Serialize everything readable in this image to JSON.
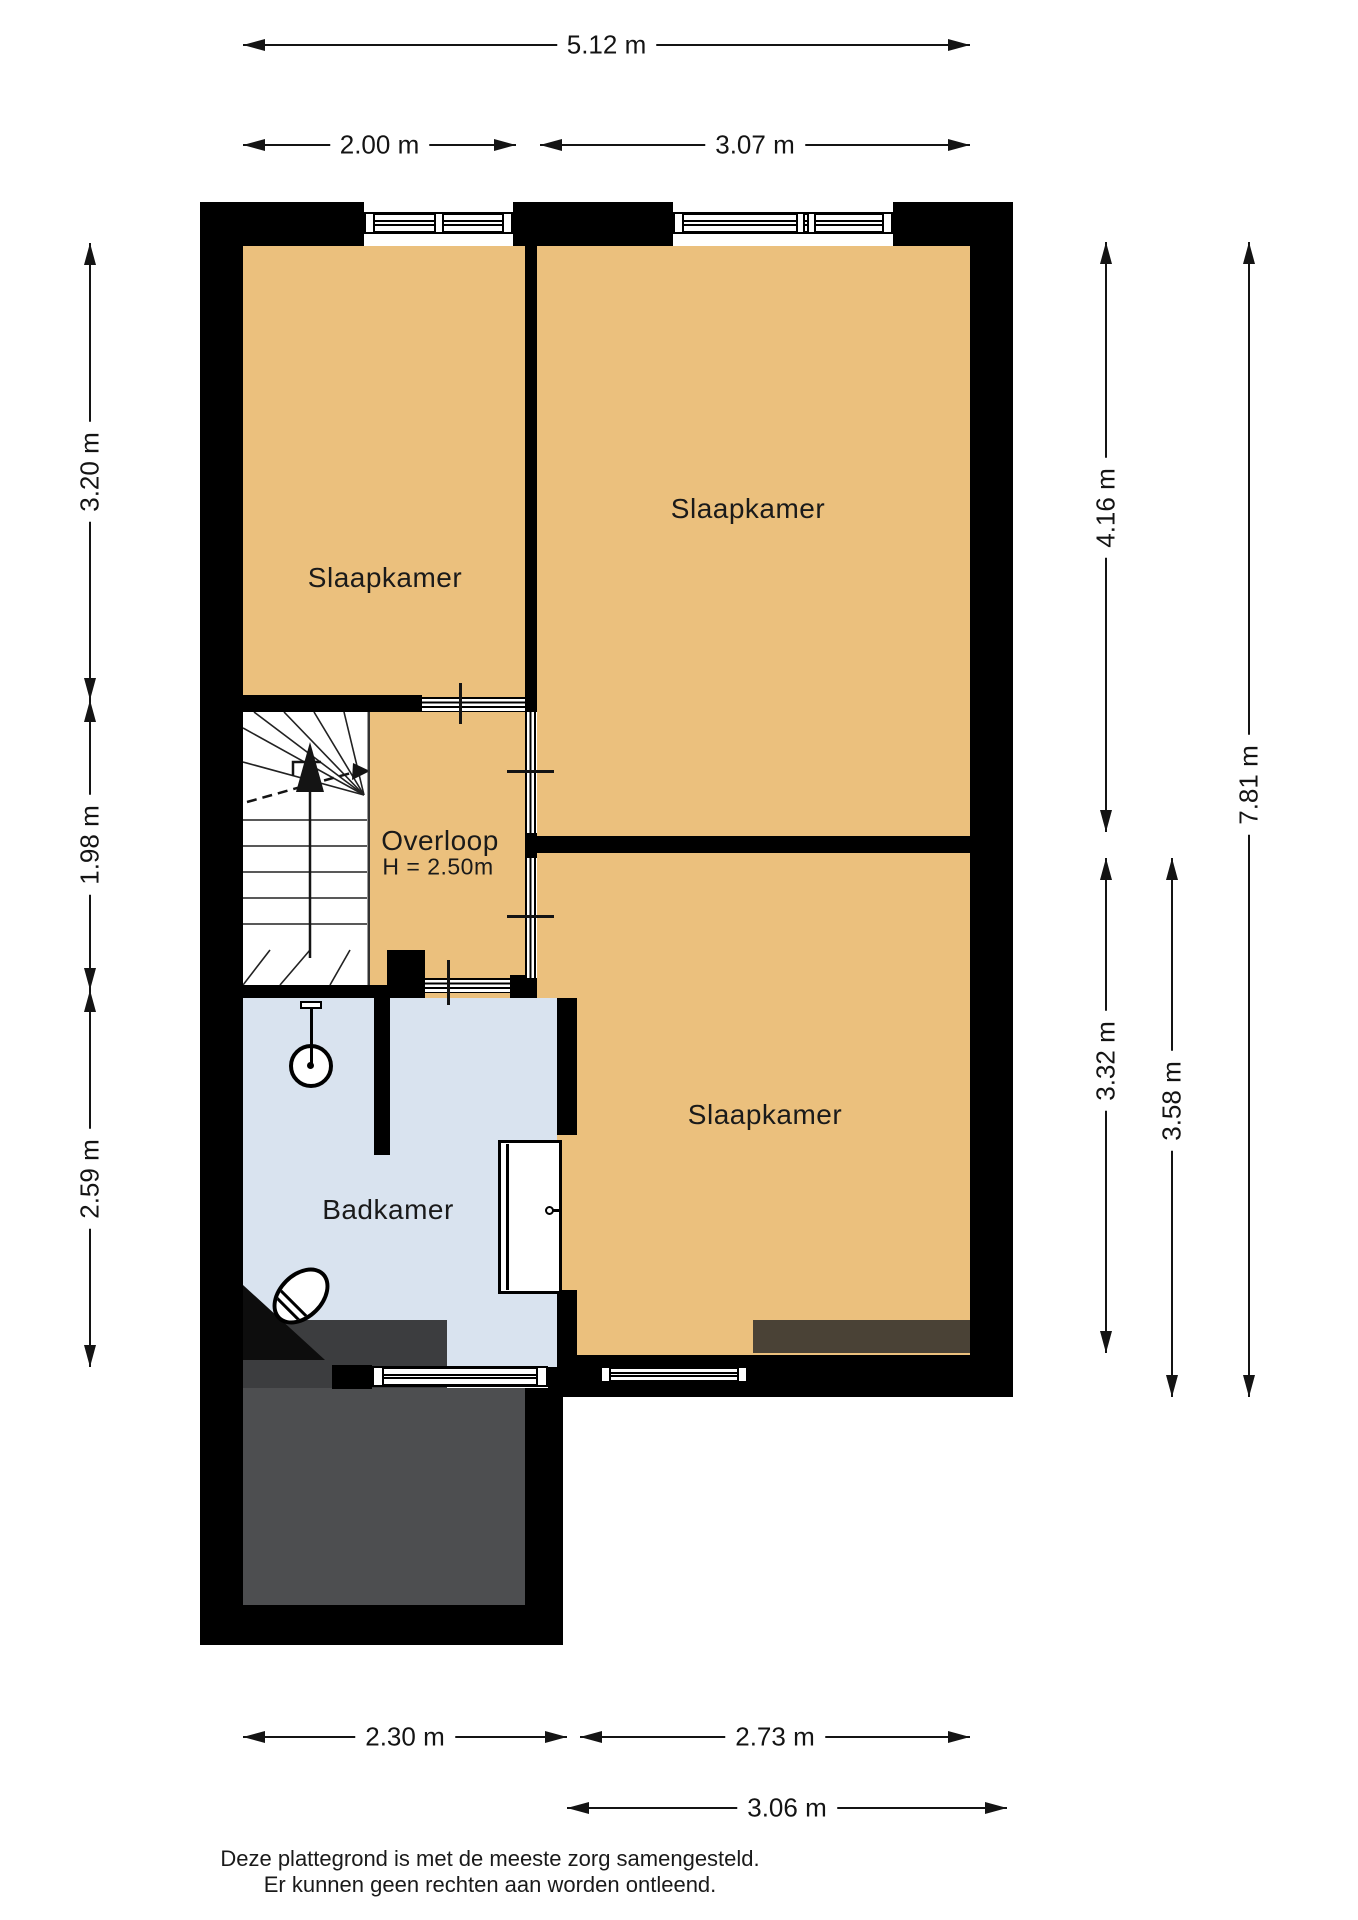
{
  "plan": {
    "rooms": {
      "bedroom_top_left": "Slaapkamer",
      "bedroom_top_right": "Slaapkamer",
      "bedroom_bottom_right": "Slaapkamer",
      "bathroom": "Badkamer",
      "landing": "Overloop",
      "landing_ceiling_height": "H = 2.50m"
    },
    "dimensions": {
      "top_total": "5.12 m",
      "top_left_room": "2.00 m",
      "top_right_room": "3.07 m",
      "left_top": "3.20 m",
      "left_middle": "1.98 m",
      "left_bottom": "2.59 m",
      "right_upper_room": "4.16 m",
      "right_lower_room": "3.32 m",
      "right_lower_outer": "3.58 m",
      "right_total": "7.81 m",
      "bottom_bathroom": "2.30 m",
      "bottom_bedroom": "2.73 m",
      "bottom_outer": "3.06 m"
    },
    "footer": {
      "line1": "Deze plattegrond is met de meeste zorg samengesteld.",
      "line2": "Er kunnen geen rechten aan worden ontleend."
    },
    "colors": {
      "room_fill": "#ebc07d",
      "bathroom_fill": "#d9e3ef",
      "wall": "#000000",
      "roof_dark": "#3c3d3f",
      "roof_light": "#4d4e50",
      "dormer_brown": "#4a4236"
    }
  }
}
